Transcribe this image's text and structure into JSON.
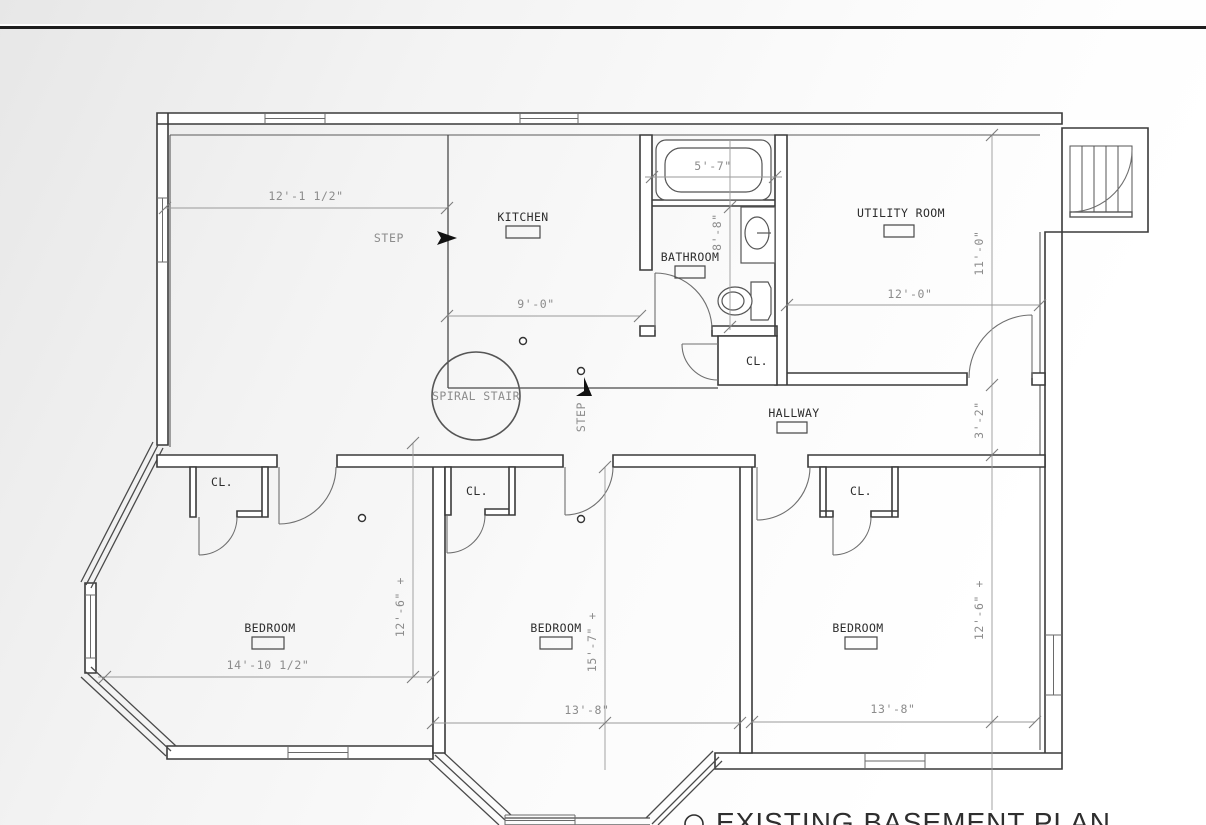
{
  "sheet": {
    "title": "EXISTING BASEMENT PLAN",
    "line_color": "#1d1d1d",
    "wall_color": "#3a3a3a",
    "dim_color": "#8c8c8c"
  },
  "rooms": {
    "kitchen": "KITCHEN",
    "bathroom": "BATHROOM",
    "utility_room": "UTILITY ROOM",
    "hallway": "HALLWAY",
    "spiral_stair": "SPIRAL STAIR",
    "bedrooms": [
      "BEDROOM",
      "BEDROOM",
      "BEDROOM"
    ],
    "closets": [
      "CL.",
      "CL.",
      "CL.",
      "CL."
    ]
  },
  "annotations": {
    "steps": [
      "STEP",
      "STEP"
    ]
  },
  "dimensions": {
    "kitchen_width": "12'-1 1/2\"",
    "kitchen_depth": "9'-0\"",
    "tub_width": "5'-7\"",
    "bath_depth": "8'-8\"",
    "utility_width": "12'-0\"",
    "utility_depth": "11'-0\"",
    "hallway_width": "3'-2\"",
    "bedroom_left_depth": "12'-6\" +",
    "bedroom_left_width": "14'-10 1/2\"",
    "bedroom_middle_depth": "15'-7\" +",
    "bedroom_middle_width": "13'-8\"",
    "bedroom_right_depth": "12'-6\" +",
    "bedroom_right_width": "13'-8\""
  }
}
